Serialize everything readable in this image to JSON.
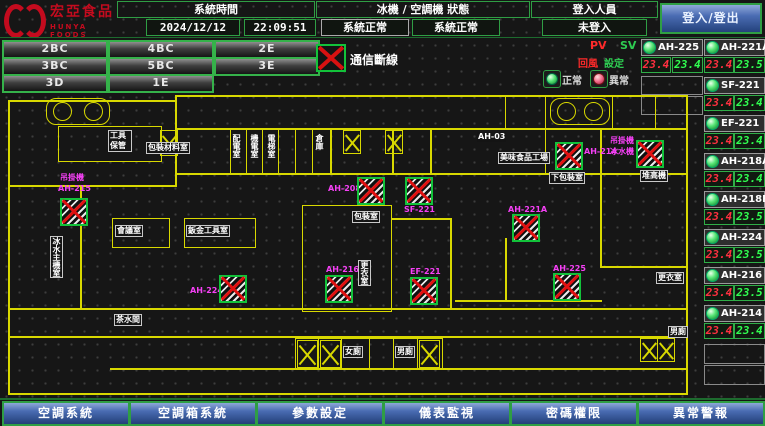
{
  "header": {
    "logo_line1": "宏亞食品",
    "logo_line2": "HUNYA FOODS",
    "time_label": "系統時間",
    "date": "2024/12/12",
    "time": "22:09:51",
    "status_label": "冰機 / 空調機 狀態",
    "chiller_status": "系統正常",
    "ahu_status": "系統正常",
    "login_label": "登入人員",
    "login_value": "未登入",
    "login_button": "登入/登出"
  },
  "floors": [
    "2BC",
    "4BC",
    "2E",
    "3BC",
    "5BC",
    "3E",
    "3D",
    "1E"
  ],
  "legend": {
    "comm_loss": "通信斷線",
    "pv": "PV",
    "sv": "SV",
    "pv_name": "回風",
    "sv_name": "設定",
    "normal": "正常",
    "abnormal": "異常"
  },
  "units": [
    {
      "name": "AH-225",
      "pv": "23.4",
      "sv": "23.4"
    },
    {
      "name": "AH-221A",
      "pv": "23.4",
      "sv": "23.5"
    },
    {
      "name": "SF-221",
      "pv": "23.4",
      "sv": "23.4"
    },
    {
      "name": "EF-221",
      "pv": "23.4",
      "sv": "23.4"
    },
    {
      "name": "AH-218A",
      "pv": "23.4",
      "sv": "23.4"
    },
    {
      "name": "AH-218B",
      "pv": "23.4",
      "sv": "23.5"
    },
    {
      "name": "AH-224",
      "pv": "23.4",
      "sv": "23.5"
    },
    {
      "name": "AH-216",
      "pv": "23.4",
      "sv": "23.5"
    },
    {
      "name": "AH-214",
      "pv": "23.4",
      "sv": "23.4"
    }
  ],
  "map": {
    "equipment": [
      {
        "line1": "吊掛機",
        "id": "AH-215"
      },
      {
        "id": "AH-208"
      },
      {
        "id": "SF-221"
      },
      {
        "id": "AH-214"
      },
      {
        "line1": "吊掛機",
        "id": "冰水機"
      },
      {
        "id": "AH-221A"
      },
      {
        "id": "AH-224"
      },
      {
        "id": "AH-216"
      },
      {
        "id": "EF-221"
      },
      {
        "id": "AH-225"
      }
    ],
    "rooms": [
      {
        "text": "工具保管"
      },
      {
        "text": "包裝材料室"
      },
      {
        "text": "AH-03"
      },
      {
        "text": "美味食品工場"
      },
      {
        "text": "下包裝室"
      },
      {
        "text": "堆高機"
      },
      {
        "text": "包裝室"
      },
      {
        "text": "鈑金工具室"
      },
      {
        "text": "會議室"
      },
      {
        "text": "冰水主機室"
      },
      {
        "text": "更衣室"
      },
      {
        "text": "茶水間"
      },
      {
        "text": "女廁"
      },
      {
        "text": "男廁"
      },
      {
        "text": "更衣室"
      },
      {
        "text": "男廁"
      },
      {
        "text": "配電室"
      },
      {
        "text": "機電室"
      },
      {
        "text": "電梯室"
      },
      {
        "text": "倉庫"
      }
    ]
  },
  "nav": [
    "空調系統",
    "空調箱系統",
    "參數設定",
    "儀表監視",
    "密碼權限",
    "異常警報"
  ]
}
